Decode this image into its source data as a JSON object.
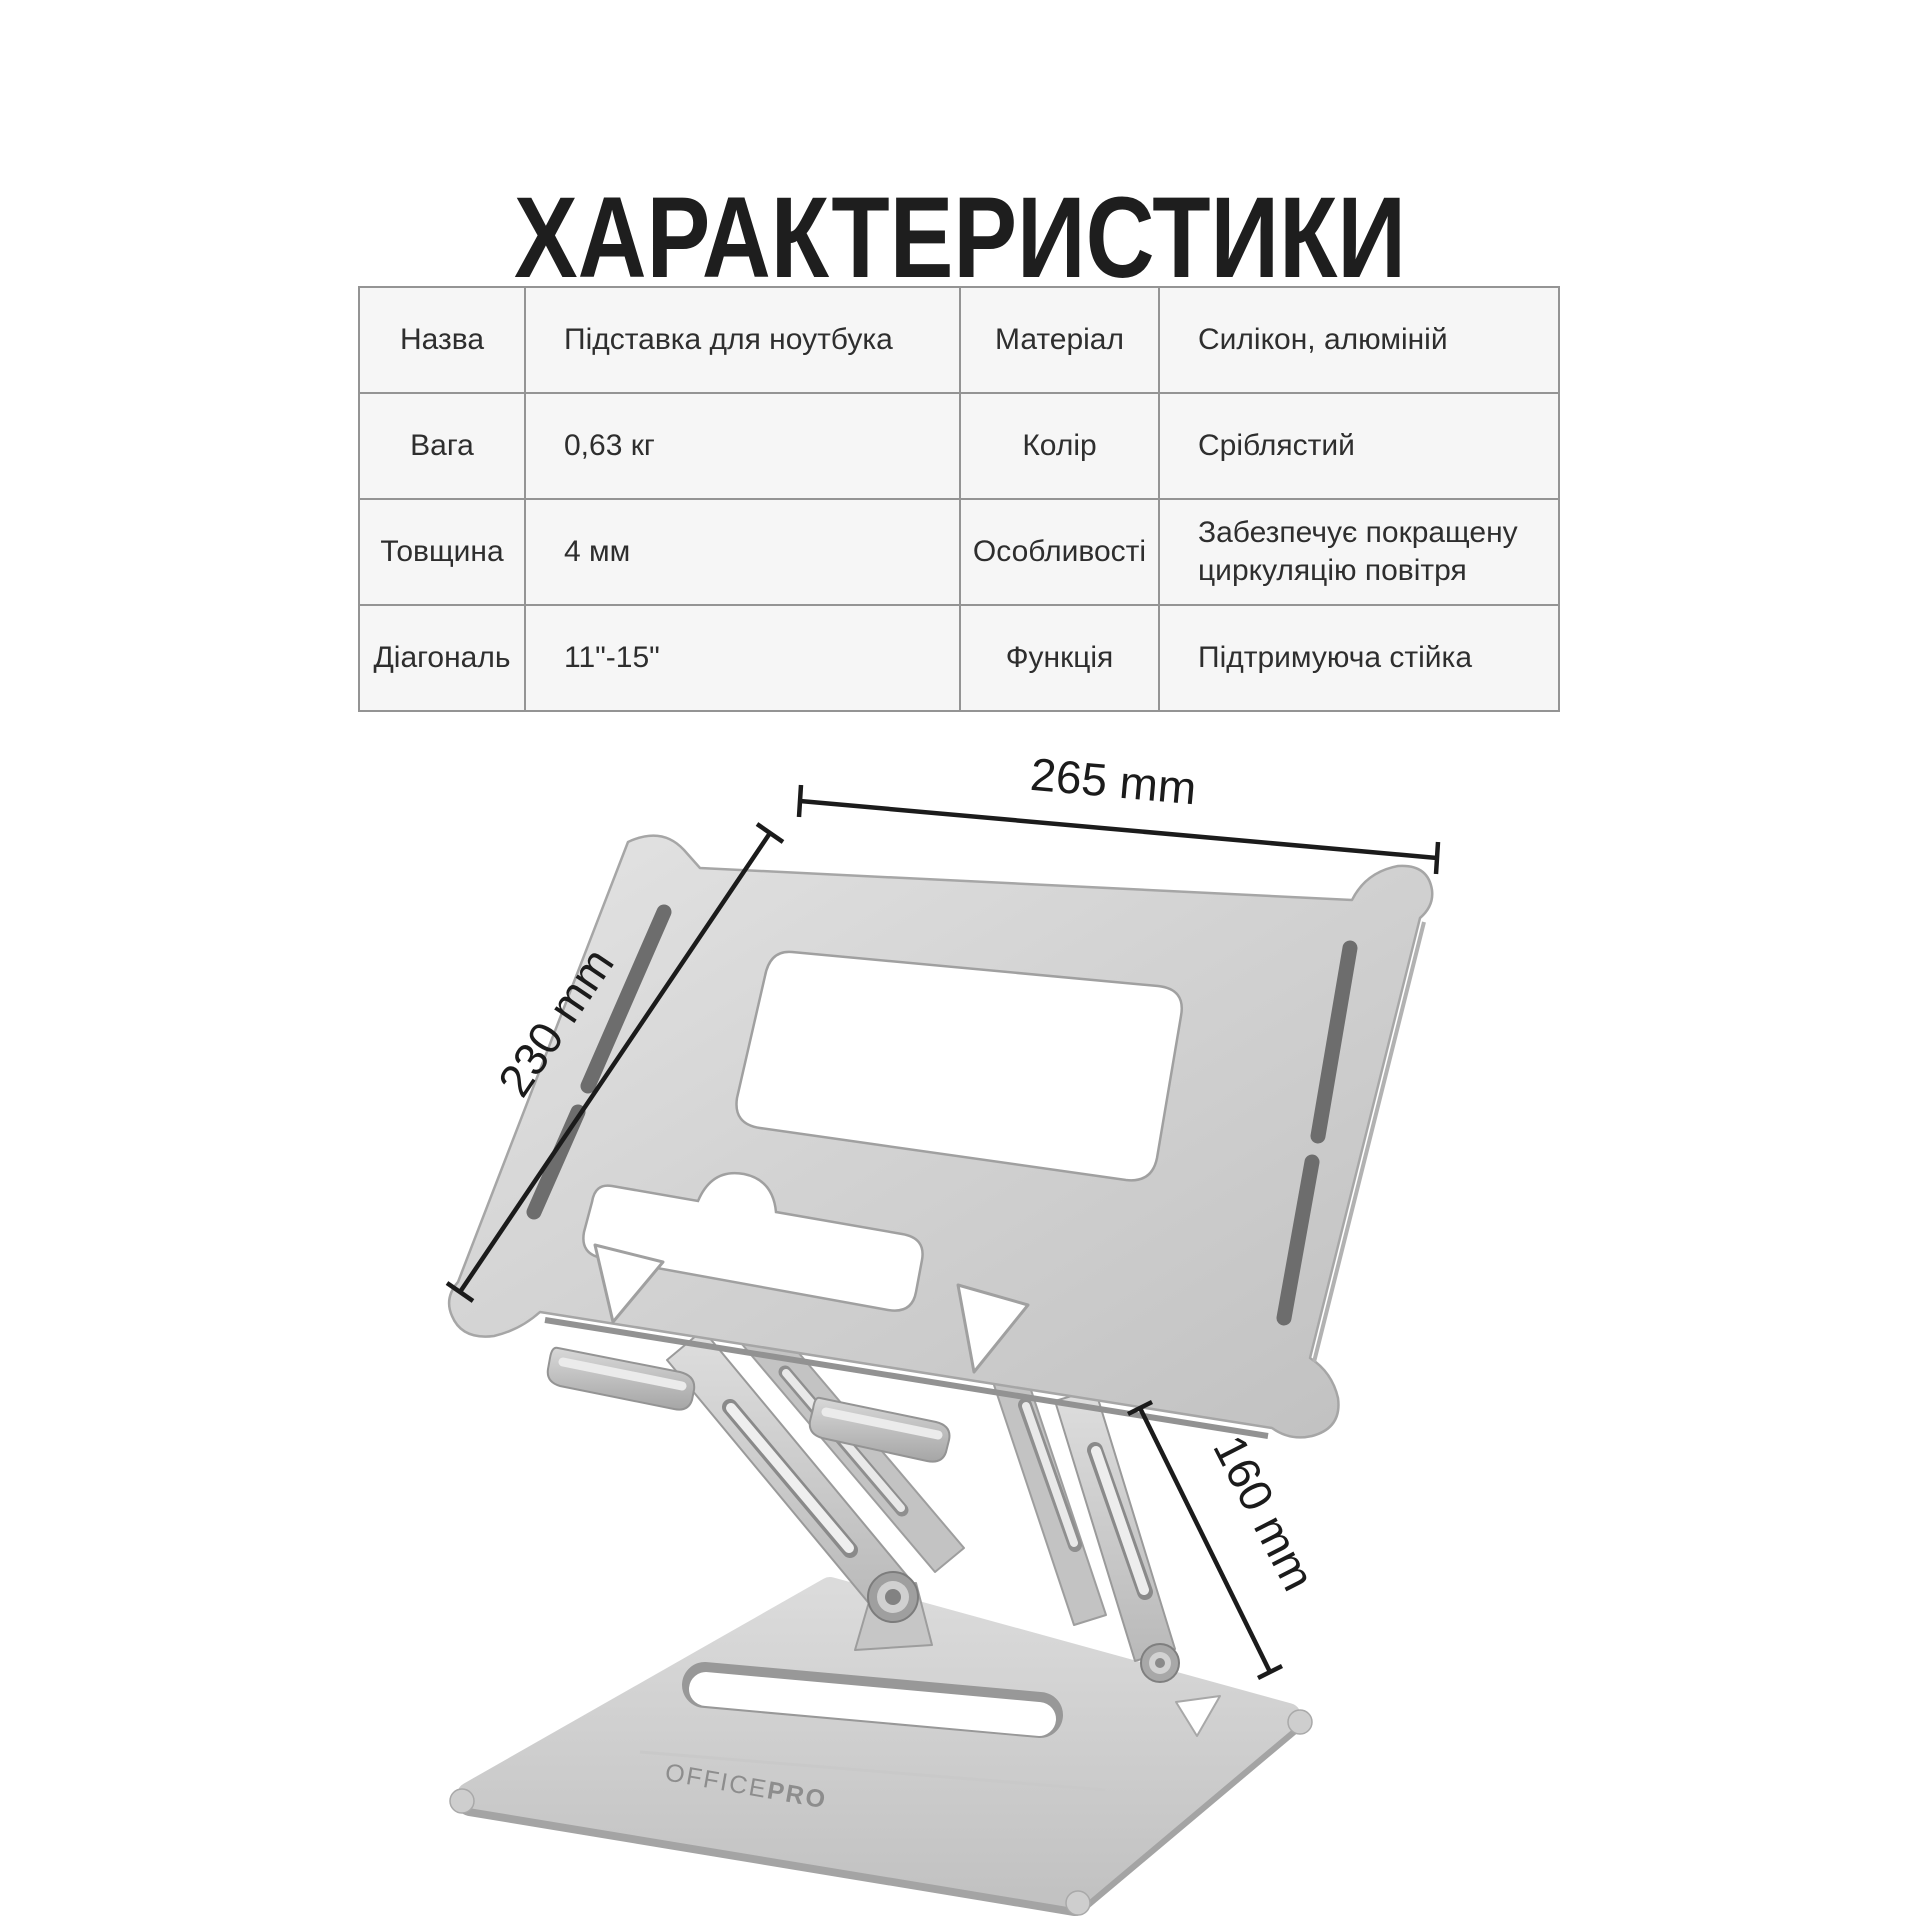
{
  "page": {
    "title": "ХАРАКТЕРИСТИКИ",
    "background": "#ffffff"
  },
  "spec_table": {
    "rows": [
      {
        "cells": [
          "Назва",
          "Підставка для ноутбука",
          "Матеріал",
          "Силікон, алюміній"
        ]
      },
      {
        "cells": [
          "Вага",
          "0,63 кг",
          "Колір",
          "Сріблястий"
        ]
      },
      {
        "cells": [
          "Товщина",
          "4 мм",
          "Особливості",
          "Забезпечує покращену циркуляцію повітря"
        ]
      },
      {
        "cells": [
          "Діагональ",
          "11\"-15\"",
          "Функція",
          "Підтримуюча стійка"
        ]
      }
    ]
  },
  "diagram": {
    "dim_width": "265 mm",
    "dim_depth": "230 mm",
    "dim_height": "160 mm",
    "brand_part1": "OFFICE",
    "brand_part2": "PRO"
  },
  "colors": {
    "annotation": "#1b1b1b",
    "table_border": "#949494",
    "cell_background": "#f6f6f6",
    "metal_light": "#e3e3e3",
    "metal_dark": "#bdbdbd",
    "rubber_strip": "#6d6d6d"
  }
}
